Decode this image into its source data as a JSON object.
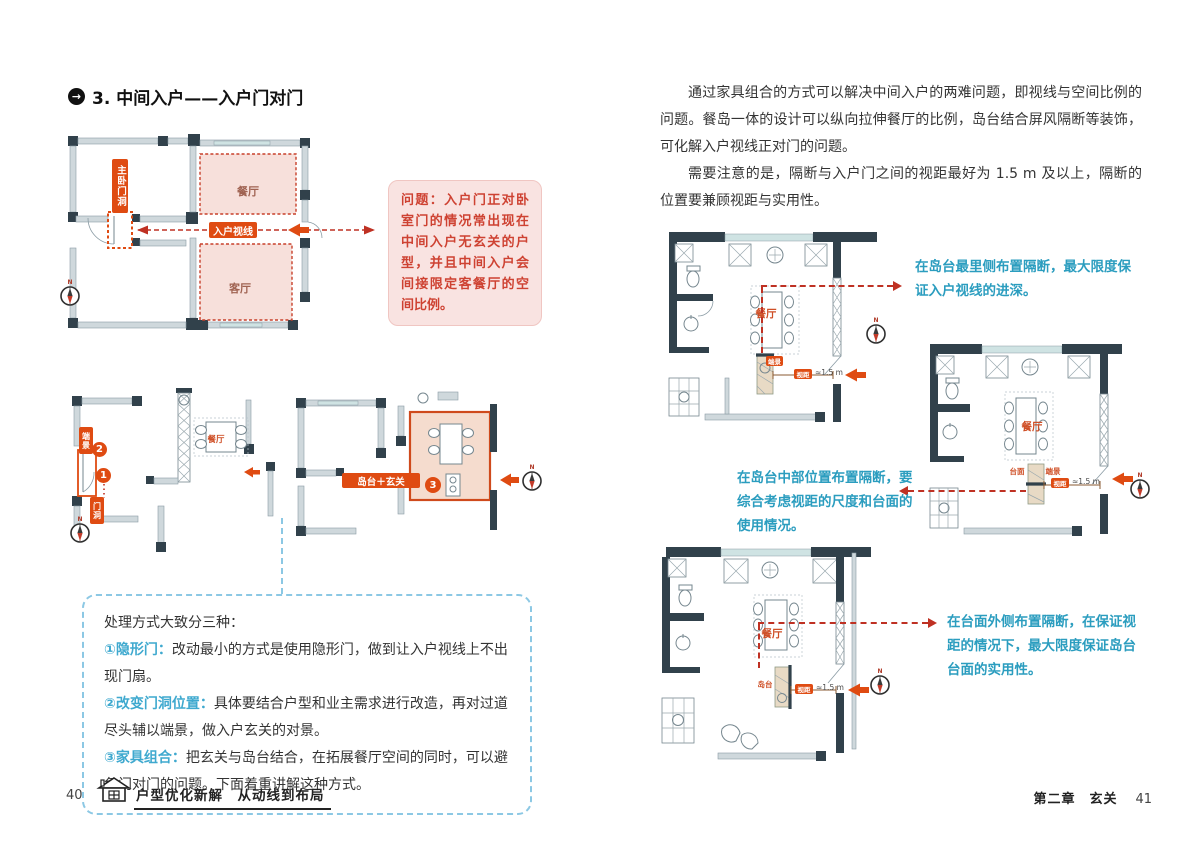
{
  "page": {
    "left_number": "40",
    "right_number": "41",
    "book_title": "户型优化新解　从动线到布局",
    "chapter": "第二章　玄关"
  },
  "icons": {
    "heading_arrow": "→"
  },
  "heading": "3. 中间入户——入户门对门",
  "problem_note": "问题：入户门正对卧室门的情况常出现在中间入户无玄关的户型，并且中间入户会间接限定客餐厅的空间比例。",
  "plan_top": {
    "bedroom_door": "主卧门洞",
    "dining": "餐厅",
    "living": "客厅",
    "sightline": "入户视线"
  },
  "plan_mid": {
    "end_view": "端景",
    "num2": "2",
    "num1": "1",
    "door_opening": "门洞",
    "dining": "餐厅"
  },
  "plan_combo": {
    "island_entry": "岛台＋玄关",
    "num3": "3"
  },
  "methods": {
    "intro": "处理方式大致分三种：",
    "items": [
      {
        "label": "①隐形门：",
        "text": "改动最小的方式是使用隐形门，做到让入户视线上不出现门扇。"
      },
      {
        "label": "②改变门洞位置：",
        "text": "具体要结合户型和业主需求进行改造，再对过道尽头辅以端景，做入户玄关的对景。"
      },
      {
        "label": "③家具组合：",
        "text": "把玄关与岛台结合，在拓展餐厅空间的同时，可以避免门对门的问题。下面着重讲解这种方式。"
      }
    ]
  },
  "paragraphs": [
    "通过家具组合的方式可以解决中间入户的两难问题，即视线与空间比例的问题。餐岛一体的设计可以纵向拉伸餐厅的比例，岛台结合屏风隔断等装饰，可化解入户视线正对门的问题。",
    "需要注意的是，隔断与入户门之间的视距最好为 1.5 m 及以上，隔断的位置要兼顾视距与实用性。"
  ],
  "annotations": [
    "在岛台最里侧布置隔断，最大限度保证入户视线的进深。",
    "在岛台中部位置布置隔断，要综合考虑视距的尺度和台面的使用情况。",
    "在台面外侧布置隔断，在保证视距的情况下，最大限度保证岛台台面的实用性。"
  ],
  "plan_a": {
    "dining": "餐厅",
    "end_view": "端景",
    "distance_label": "视距",
    "distance_value": "≈1.5 m"
  },
  "plan_b": {
    "dining": "餐厅",
    "counter": "台面",
    "end_view": "端景",
    "distance_label": "视距",
    "distance_value": "≈1.5 m"
  },
  "plan_c": {
    "dining": "餐厅",
    "island": "岛台",
    "distance_label": "视距",
    "distance_value": "≈1.5 m"
  },
  "compass_n": "N",
  "colors": {
    "accent": "#df4b12",
    "red_line": "#bf3123",
    "teal_text": "#2b9dbf",
    "pink_bg": "#f9e3e1",
    "pink_text": "#ce4232",
    "blue_dash": "#8cc8e4",
    "wall_dark": "#31414b",
    "wall_light": "#cfd8dc"
  }
}
